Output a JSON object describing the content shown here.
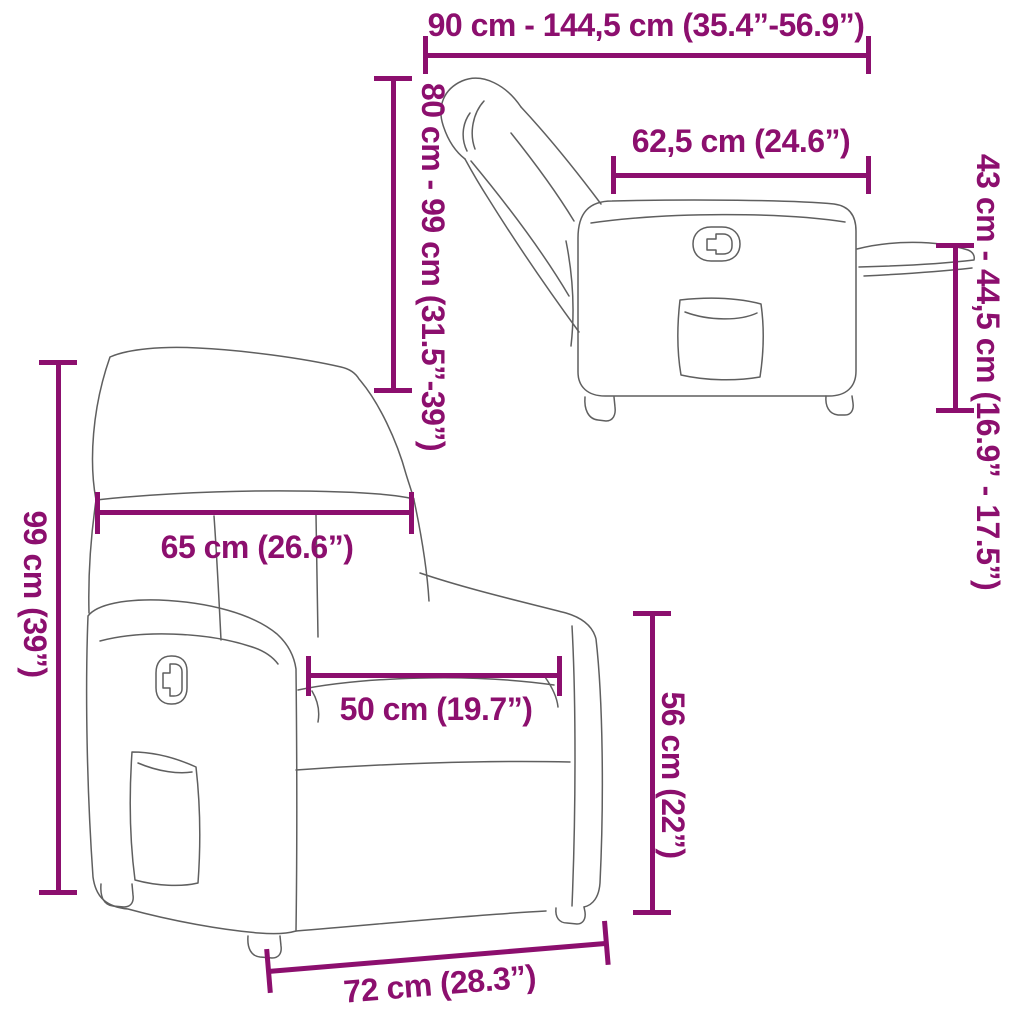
{
  "colors": {
    "accent": "#8C0F6E",
    "line": "#5f5f5f"
  },
  "dimensions": {
    "reclined_length": {
      "label": "90 cm - 144,5 cm (35.4”-56.9”)"
    },
    "seat_top_depth": {
      "label": "62,5 cm (24.6”)"
    },
    "reclined_height": {
      "label": "80 cm - 99 cm (31.5”-39”)"
    },
    "footrest_height": {
      "label": "43 cm - 44,5 cm (16.9” - 17.5”)"
    },
    "total_height": {
      "label": "99 cm (39”)"
    },
    "back_width": {
      "label": "65 cm (26.6”)"
    },
    "seat_width": {
      "label": "50 cm (19.7”)"
    },
    "armrest_height": {
      "label": "56 cm (22”)"
    },
    "base_width": {
      "label": "72 cm (28.3”)"
    }
  }
}
